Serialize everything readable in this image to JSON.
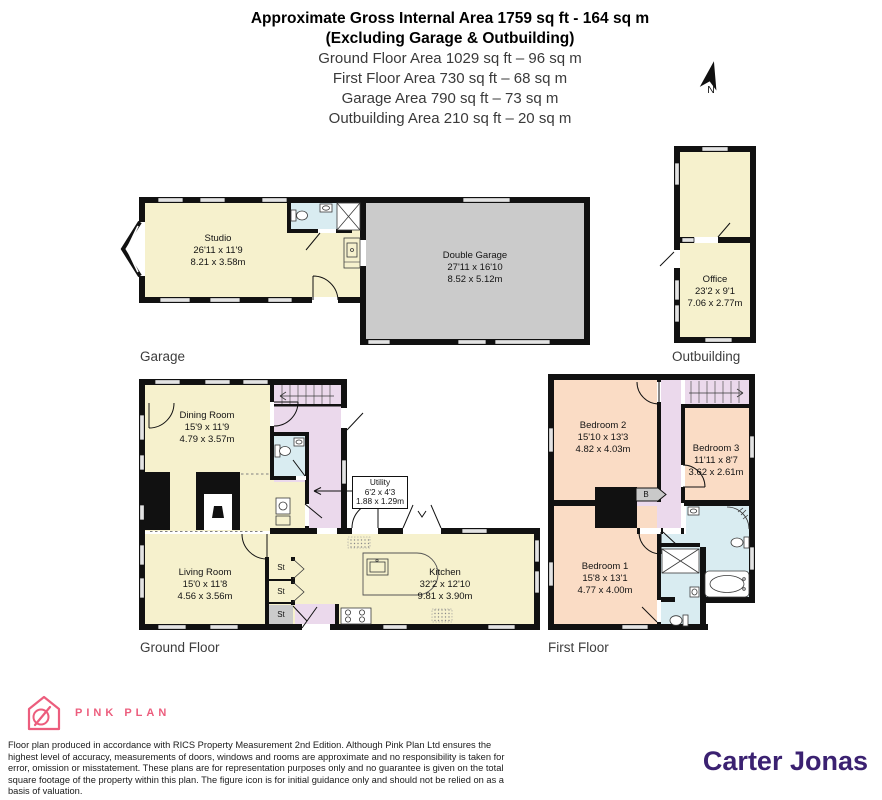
{
  "header": {
    "line1": "Approximate Gross Internal Area 1759 sq ft - 164 sq m",
    "line2": "(Excluding Garage & Outbuilding)",
    "line3": "Ground Floor Area 1029 sq ft – 96 sq m",
    "line4": "First Floor Area 730 sq ft – 68 sq m",
    "line5": "Garage Area 790 sq ft – 73 sq m",
    "line6": "Outbuilding Area 210 sq ft – 20 sq m"
  },
  "compass": {
    "label": "N"
  },
  "garage": {
    "section_label": "Garage",
    "studio": {
      "name": "Studio",
      "imperial": "26'11 x 11'9",
      "metric": "8.21 x 3.58m"
    },
    "double_garage": {
      "name": "Double Garage",
      "imperial": "27'11 x 16'10",
      "metric": "8.52 x 5.12m"
    }
  },
  "outbuilding": {
    "section_label": "Outbuilding",
    "office": {
      "name": "Office",
      "imperial": "23'2 x 9'1",
      "metric": "7.06 x 2.77m"
    }
  },
  "ground_floor": {
    "section_label": "Ground Floor",
    "dining": {
      "name": "Dining Room",
      "imperial": "15'9 x 11'9",
      "metric": "4.79 x 3.57m"
    },
    "living": {
      "name": "Living Room",
      "imperial": "15'0 x 11'8",
      "metric": "4.56 x 3.56m"
    },
    "kitchen": {
      "name": "Kitchen",
      "imperial": "32'2 x 12'10",
      "metric": "9.81 x 3.90m"
    },
    "utility": {
      "name": "Utility",
      "imperial": "6'2 x 4'3",
      "metric": "1.88 x 1.29m"
    },
    "st1": "St",
    "st2": "St",
    "st3": "St"
  },
  "first_floor": {
    "section_label": "First Floor",
    "bedroom1": {
      "name": "Bedroom 1",
      "imperial": "15'8 x 13'1",
      "metric": "4.77 x 4.00m"
    },
    "bedroom2": {
      "name": "Bedroom 2",
      "imperial": "15'10 x 13'3",
      "metric": "4.82 x 4.03m"
    },
    "bedroom3": {
      "name": "Bedroom 3",
      "imperial": "11'11 x 8'7",
      "metric": "3.62 x 2.61m"
    },
    "boiler": "B"
  },
  "footer": {
    "brand": "PINK PLAN",
    "disclaimer": "Floor plan produced in accordance with RICS Property Measurement 2nd Edition. Although Pink Plan Ltd ensures the highest level of accuracy, measurements of doors, windows and rooms are approximate and no responsibility is taken for error, omission or misstatement. These plans are for representation purposes only and no guarantee is given on the total square footage of the property within this plan. The figure icon is for initial guidance only and should not be relied on as a basis of valuation.",
    "agency": "Carter Jonas"
  },
  "colors": {
    "room_cream": "#F6F1CD",
    "garage_gray": "#CBCBCB",
    "hall_lavender": "#EBD9EC",
    "bedroom_peach": "#FADCC5",
    "bath_blue": "#D9ECF1",
    "wall_black": "#111111",
    "brand_pink": "#EC5D7D",
    "agency_purple": "#3B2171"
  }
}
